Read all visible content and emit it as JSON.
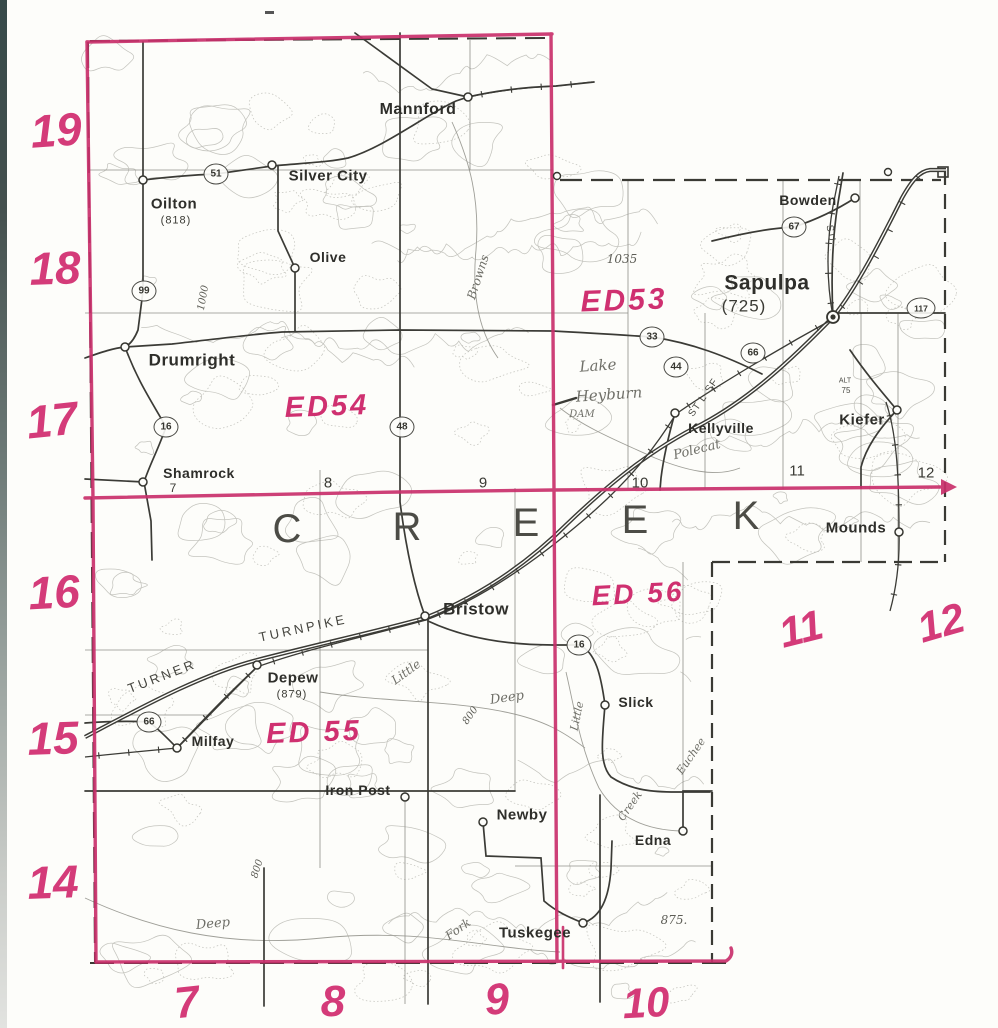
{
  "map_title": "Creek County enumeration district map",
  "red_color": "#c9306b",
  "layers": [
    {
      "name": "red-row-numbers",
      "item_name": "red-row-number",
      "cls": "bignum",
      "items": [
        {
          "t": "19",
          "x": 56,
          "y": 130,
          "fs": 46,
          "rot": -4
        },
        {
          "t": "18",
          "x": 55,
          "y": 268,
          "fs": 46,
          "rot": -2
        },
        {
          "t": "17",
          "x": 52,
          "y": 420,
          "fs": 46,
          "rot": -6
        },
        {
          "t": "16",
          "x": 54,
          "y": 592,
          "fs": 46,
          "rot": -3
        },
        {
          "t": "15",
          "x": 53,
          "y": 738,
          "fs": 46,
          "rot": -2
        },
        {
          "t": "14",
          "x": 53,
          "y": 882,
          "fs": 46,
          "rot": -2
        }
      ]
    },
    {
      "name": "red-col-numbers",
      "item_name": "red-col-number",
      "cls": "bignum",
      "items": [
        {
          "t": "7",
          "x": 187,
          "y": 1003,
          "fs": 44,
          "rot": -6
        },
        {
          "t": "8",
          "x": 333,
          "y": 1002,
          "fs": 44,
          "rot": 0
        },
        {
          "t": "9",
          "x": 497,
          "y": 1000,
          "fs": 44,
          "rot": -4
        },
        {
          "t": "10",
          "x": 646,
          "y": 1003,
          "fs": 42,
          "rot": -3
        }
      ]
    },
    {
      "name": "red-side-numbers",
      "item_name": "red-side-number",
      "cls": "bignum",
      "items": [
        {
          "t": "11",
          "x": 801,
          "y": 629,
          "fs": 42,
          "rot": -14
        },
        {
          "t": "12",
          "x": 941,
          "y": 623,
          "fs": 42,
          "rot": -16
        }
      ]
    },
    {
      "name": "ed-labels",
      "item_name": "ed-label",
      "cls": "ed",
      "items": [
        {
          "t": "ED53",
          "x": 624,
          "y": 301,
          "fs": 30,
          "rot": -2
        },
        {
          "t": "ED54",
          "x": 327,
          "y": 407,
          "fs": 29,
          "rot": -2
        },
        {
          "t": "ED 55",
          "x": 314,
          "y": 733,
          "fs": 29,
          "rot": -2
        },
        {
          "t": "ED 56",
          "x": 638,
          "y": 594,
          "fs": 28,
          "rot": -3
        }
      ]
    },
    {
      "name": "county-letters",
      "item_name": "county-name-letter",
      "cls": "cletter",
      "items": [
        {
          "t": "C",
          "x": 287,
          "y": 529,
          "fs": 40
        },
        {
          "t": "R",
          "x": 407,
          "y": 527,
          "fs": 40
        },
        {
          "t": "E",
          "x": 526,
          "y": 523,
          "fs": 40
        },
        {
          "t": "E",
          "x": 635,
          "y": 520,
          "fs": 40
        },
        {
          "t": "K",
          "x": 746,
          "y": 516,
          "fs": 40
        }
      ]
    },
    {
      "name": "section-numbers",
      "item_name": "section-number",
      "cls": "blacknum",
      "items": [
        {
          "t": "7",
          "x": 173,
          "y": 488,
          "fs": 12
        },
        {
          "t": "8",
          "x": 328,
          "y": 483,
          "fs": 15
        },
        {
          "t": "9",
          "x": 483,
          "y": 483,
          "fs": 15
        },
        {
          "t": "10",
          "x": 640,
          "y": 483,
          "fs": 15
        },
        {
          "t": "11",
          "x": 797,
          "y": 471,
          "fs": 15
        },
        {
          "t": "12",
          "x": 926,
          "y": 473,
          "fs": 15
        }
      ]
    },
    {
      "name": "hydro-labels",
      "item_name": "water-feature-label",
      "cls": "hydro",
      "items": [
        {
          "t": "Browns",
          "x": 478,
          "y": 277,
          "fs": 12,
          "rot": -72
        },
        {
          "t": "Lake",
          "x": 598,
          "y": 366,
          "fs": 15,
          "rot": -4
        },
        {
          "t": "Heyburn",
          "x": 609,
          "y": 395,
          "fs": 15,
          "rot": -4
        },
        {
          "t": "DAM",
          "x": 582,
          "y": 415,
          "fs": 10,
          "rot": 0
        },
        {
          "t": "Polecat",
          "x": 697,
          "y": 450,
          "fs": 13,
          "rot": -14
        },
        {
          "t": "Little",
          "x": 406,
          "y": 672,
          "fs": 12,
          "rot": -36
        },
        {
          "t": "Deep",
          "x": 507,
          "y": 698,
          "fs": 13,
          "rot": -8
        },
        {
          "t": "Deep",
          "x": 213,
          "y": 924,
          "fs": 13,
          "rot": -5
        },
        {
          "t": "Fork",
          "x": 458,
          "y": 929,
          "fs": 12,
          "rot": -35
        },
        {
          "t": "Little",
          "x": 577,
          "y": 716,
          "fs": 11,
          "rot": -78
        },
        {
          "t": "Creek",
          "x": 630,
          "y": 806,
          "fs": 11,
          "rot": -55
        },
        {
          "t": "Euchee",
          "x": 691,
          "y": 756,
          "fs": 11,
          "rot": -55
        }
      ]
    },
    {
      "name": "elevation-labels",
      "item_name": "elevation-label",
      "cls": "elevlbl",
      "items": [
        {
          "t": "1035",
          "x": 622,
          "y": 259,
          "fs": 12
        },
        {
          "t": "875.",
          "x": 674,
          "y": 920,
          "fs": 12
        },
        {
          "t": "800",
          "x": 471,
          "y": 716,
          "fs": 10,
          "rot": -55
        },
        {
          "t": "800",
          "x": 258,
          "y": 869,
          "fs": 10,
          "rot": -72
        },
        {
          "t": "1000",
          "x": 204,
          "y": 298,
          "fs": 10,
          "rot": -80
        }
      ]
    },
    {
      "name": "railroad-labels",
      "item_name": "railroad-label",
      "cls": "raillbl",
      "items": [
        {
          "t": "SU",
          "x": 830,
          "y": 234,
          "fs": 10,
          "rot": 80,
          "ls": 2
        },
        {
          "t": "ST L-SF",
          "x": 704,
          "y": 398,
          "fs": 10,
          "rot": -55,
          "ls": 1
        },
        {
          "t": "ALT",
          "x": 845,
          "y": 381,
          "fs": 7
        },
        {
          "t": "75",
          "x": 846,
          "y": 391,
          "fs": 8
        }
      ]
    },
    {
      "name": "turnpike-labels",
      "item_name": "turnpike-label",
      "cls": "tpklbl",
      "items": [
        {
          "t": "TURNER",
          "x": 162,
          "y": 676,
          "fs": 13,
          "rot": -21
        },
        {
          "t": "TURNPIKE",
          "x": 303,
          "y": 628,
          "fs": 13,
          "rot": -12
        }
      ]
    }
  ],
  "towns": [
    {
      "name": "Oilton",
      "lx": 174,
      "ly": 204,
      "fs": 15,
      "dx": 143,
      "dy": 180,
      "elev": "(818)",
      "ex": 176,
      "ey": 221
    },
    {
      "name": "Silver City",
      "lx": 328,
      "ly": 176,
      "fs": 15,
      "dx": 272,
      "dy": 165
    },
    {
      "name": "Mannford",
      "lx": 418,
      "ly": 110,
      "fs": 16,
      "dx": 468,
      "dy": 97
    },
    {
      "name": "Olive",
      "lx": 328,
      "ly": 257,
      "fs": 14,
      "dx": 295,
      "dy": 268
    },
    {
      "name": "Drumright",
      "lx": 192,
      "ly": 360,
      "fs": 17,
      "dx": 125,
      "dy": 347
    },
    {
      "name": "Shamrock",
      "lx": 199,
      "ly": 473,
      "fs": 14,
      "dx": 143,
      "dy": 482
    },
    {
      "name": "Bristow",
      "lx": 476,
      "ly": 609,
      "fs": 17,
      "dx": 425,
      "dy": 616
    },
    {
      "name": "Depew",
      "lx": 293,
      "ly": 678,
      "fs": 15,
      "dx": 257,
      "dy": 665,
      "elev": "(879)",
      "ex": 292,
      "ey": 695
    },
    {
      "name": "Milfay",
      "lx": 213,
      "ly": 741,
      "fs": 14,
      "dx": 177,
      "dy": 748
    },
    {
      "name": "Iron Post",
      "lx": 358,
      "ly": 790,
      "fs": 14,
      "dx": 405,
      "dy": 797
    },
    {
      "name": "Newby",
      "lx": 522,
      "ly": 815,
      "fs": 15,
      "dx": 483,
      "dy": 822
    },
    {
      "name": "Tuskegee",
      "lx": 535,
      "ly": 933,
      "fs": 15,
      "dx": 583,
      "dy": 923
    },
    {
      "name": "Edna",
      "lx": 653,
      "ly": 840,
      "fs": 14,
      "dx": 683,
      "dy": 831
    },
    {
      "name": "Slick",
      "lx": 636,
      "ly": 702,
      "fs": 14,
      "dx": 605,
      "dy": 705
    },
    {
      "name": "Kellyville",
      "lx": 721,
      "ly": 428,
      "fs": 14,
      "dx": 675,
      "dy": 413
    },
    {
      "name": "Sapulpa",
      "lx": 767,
      "ly": 283,
      "fs": 21,
      "dx": 833,
      "dy": 317,
      "big": true,
      "elev": "(725)",
      "ex": 744,
      "ey": 306
    },
    {
      "name": "Bowden",
      "lx": 808,
      "ly": 200,
      "fs": 14,
      "dx": 855,
      "dy": 198
    },
    {
      "name": "Kiefer",
      "lx": 862,
      "ly": 420,
      "fs": 15,
      "dx": 897,
      "dy": 410
    },
    {
      "name": "Mounds",
      "lx": 856,
      "ly": 528,
      "fs": 15,
      "dx": 899,
      "dy": 532
    }
  ],
  "highway_shields": [
    {
      "num": "51",
      "x": 216,
      "y": 174
    },
    {
      "num": "99",
      "x": 144,
      "y": 291
    },
    {
      "num": "16",
      "x": 166,
      "y": 427
    },
    {
      "num": "48",
      "x": 402,
      "y": 427
    },
    {
      "num": "33",
      "x": 652,
      "y": 337
    },
    {
      "num": "44",
      "x": 676,
      "y": 367
    },
    {
      "num": "66",
      "x": 753,
      "y": 353
    },
    {
      "num": "67",
      "x": 794,
      "y": 227
    },
    {
      "num": "117",
      "x": 921,
      "y": 308,
      "w": 27
    },
    {
      "num": "16",
      "x": 579,
      "y": 645
    },
    {
      "num": "66",
      "x": 149,
      "y": 722
    }
  ],
  "extra_dots": [
    [
      557,
      176
    ],
    [
      888,
      172
    ]
  ]
}
